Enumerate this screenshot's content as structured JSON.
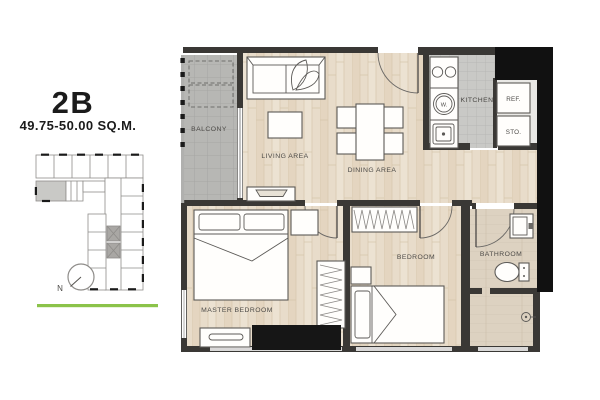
{
  "panel": {
    "unit_name": "2B",
    "unit_area": "49.75-50.00 SQ.M.",
    "compass_label": "N"
  },
  "plan": {
    "rooms": {
      "balcony": "BALCONY",
      "living": "LIVING AREA",
      "dining": "DINING AREA",
      "kitchen": "KITCHEN",
      "master_bedroom": "MASTER BEDROOM",
      "bedroom": "BEDROOM",
      "bathroom": "BATHROOM"
    },
    "fixtures": {
      "refrigerator": "REF.",
      "storage": "STO.",
      "washer": "W."
    }
  },
  "colors": {
    "accent_green": "#8bc34a",
    "wall_dark": "#3a3835",
    "unit_highlight": "#c9c9c6"
  }
}
